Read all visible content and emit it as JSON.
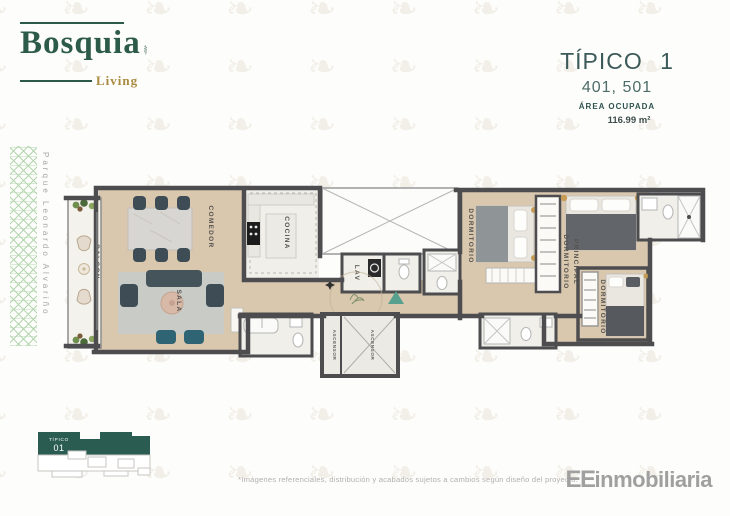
{
  "brand": {
    "name": "Bosquia",
    "tagline": "Living"
  },
  "unit": {
    "title": "TÍPICO 1",
    "numbers": "401, 501",
    "area_label": "ÁREA OCUPADA",
    "area_value": "116.99 m²"
  },
  "street": "Parque Leonardo Alvariño",
  "floorplan": {
    "rooms": {
      "balcon": "BALCON",
      "comedor": "COMEDOR",
      "sala": "SALA",
      "cocina": "COCINA",
      "lav": "LAV",
      "ascensor_1": "ASCENSOR",
      "ascensor_2": "ASCENSOR",
      "dormitorio_1": "DORMITORIO",
      "principal_line1": "DORMITORIO",
      "principal_line2": "PRINCIPAL",
      "dormitorio_2": "DORMITORIO"
    }
  },
  "keyplan": {
    "line1": "TÍPICO",
    "line2": "01"
  },
  "footer": {
    "disclaimer": "*Imágenes referenciales, distribución y acabados sujetos a cambios según diseño del proyecto.",
    "logo_ee": "EE",
    "logo_rest": "inmobiliaria"
  },
  "colors": {
    "brand_green": "#2d5b49",
    "brand_gold": "#a98a3f",
    "heading_teal": "#3c5a5a",
    "wall_gray": "#4d4d4f",
    "floor_beige": "#d9c7ae",
    "keyplan_teal": "#2a5c52",
    "accent_teal": "#2f6474",
    "pattern_green": "#a9d0a3",
    "footer_gray": "#a0a0a0"
  }
}
